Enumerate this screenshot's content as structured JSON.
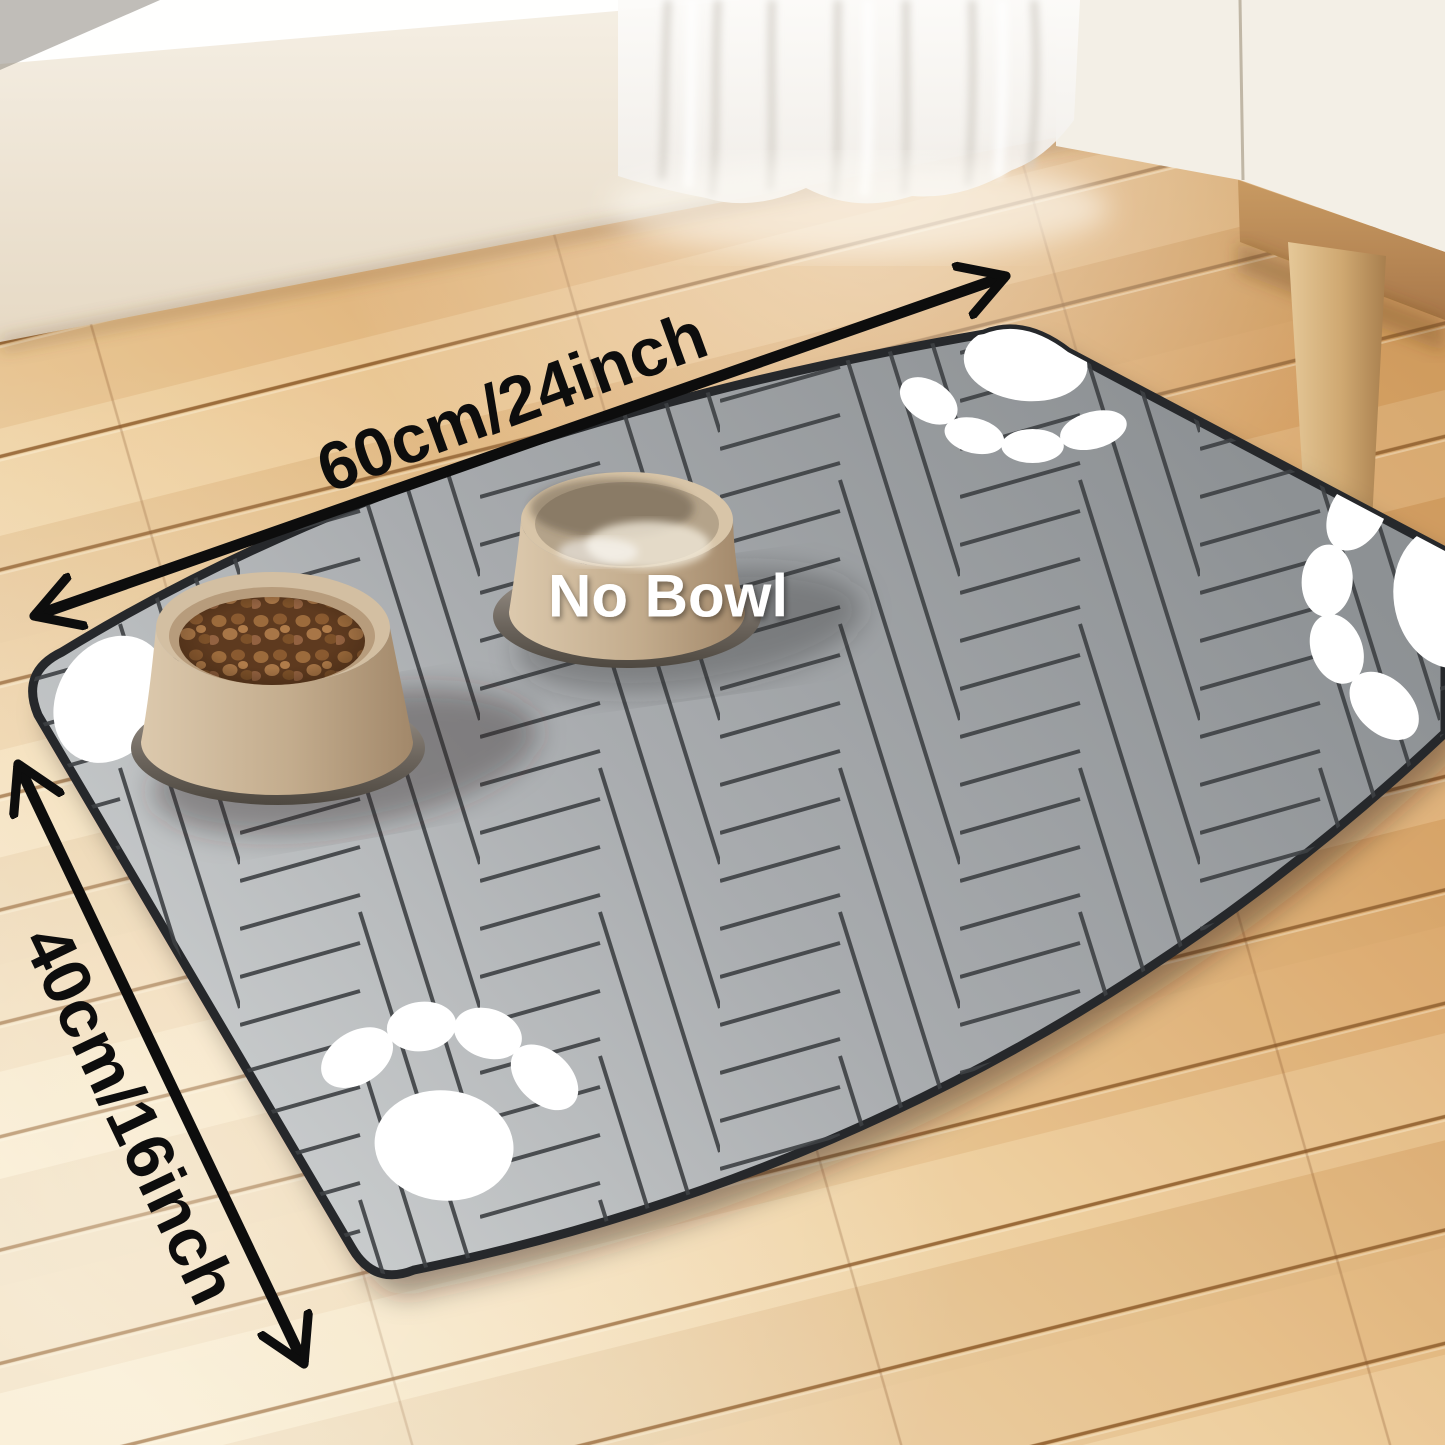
{
  "annotations": {
    "width_label": "60cm/24inch",
    "height_label": "40cm/16inch",
    "bowl_label": "No Bowl"
  },
  "icons": {
    "paw_print": "paw-print-icon",
    "dimension_arrow": "double-headed-arrow-icon"
  },
  "colors": {
    "arrow_black": "#0d0d0d",
    "dimension_text": "#0d0d0d",
    "bowl_label_text": "#ffffff",
    "paw_white": "#ffffff",
    "mat_light": "#c9cccd",
    "mat_mid": "#a9acaf",
    "mat_dark": "#8d9194",
    "mat_seam": "#3d4043",
    "mat_edge": "#26282b",
    "floor_light": "#f3e4c6",
    "floor_warm": "#d9a76e",
    "wall_cream": "#f0e8da",
    "curtain_white": "#f7f5f2",
    "bowl_tan": "#c8b295",
    "kibble_brown": "#7a4e2c"
  }
}
